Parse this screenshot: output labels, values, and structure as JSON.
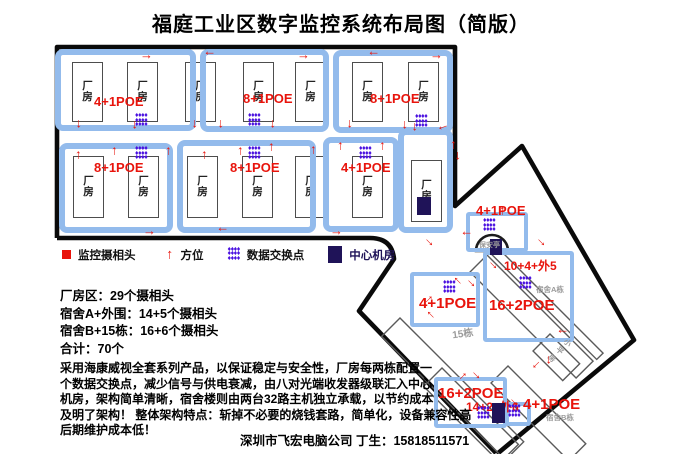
{
  "title": "福庭工业区数字监控系统布局图（简版）",
  "colors": {
    "red": "#e8140c",
    "purple": "#4a10e0",
    "navy": "#1f1358",
    "group_blue": "#93bbec"
  },
  "icons": {
    "arrow": "→",
    "dot": "♦",
    "camera": "camera-square",
    "direction": "direction-arrow",
    "switch": "switch-dots",
    "server": "server-square"
  },
  "factory": {
    "building_label": "厂\n房",
    "group_boxes": [
      {
        "x": 55,
        "y": 49,
        "w": 141,
        "h": 82
      },
      {
        "x": 200,
        "y": 49,
        "w": 129,
        "h": 83
      },
      {
        "x": 333,
        "y": 50,
        "w": 120,
        "h": 83
      },
      {
        "x": 59,
        "y": 143,
        "w": 114,
        "h": 90
      },
      {
        "x": 177,
        "y": 140,
        "w": 139,
        "h": 93
      },
      {
        "x": 323,
        "y": 137,
        "w": 76,
        "h": 95
      },
      {
        "x": 398,
        "y": 129,
        "w": 55,
        "h": 104
      }
    ],
    "buildings": [
      {
        "x": 72,
        "y": 62,
        "w": 31,
        "h": 60
      },
      {
        "x": 127,
        "y": 62,
        "w": 31,
        "h": 60
      },
      {
        "x": 185,
        "y": 62,
        "w": 31,
        "h": 60
      },
      {
        "x": 243,
        "y": 62,
        "w": 31,
        "h": 60
      },
      {
        "x": 295,
        "y": 62,
        "w": 31,
        "h": 60
      },
      {
        "x": 352,
        "y": 62,
        "w": 31,
        "h": 60
      },
      {
        "x": 408,
        "y": 62,
        "w": 31,
        "h": 60
      },
      {
        "x": 73,
        "y": 156,
        "w": 31,
        "h": 62
      },
      {
        "x": 128,
        "y": 156,
        "w": 31,
        "h": 62
      },
      {
        "x": 187,
        "y": 156,
        "w": 31,
        "h": 62
      },
      {
        "x": 242,
        "y": 156,
        "w": 31,
        "h": 62
      },
      {
        "x": 295,
        "y": 156,
        "w": 31,
        "h": 62
      },
      {
        "x": 352,
        "y": 156,
        "w": 31,
        "h": 62
      },
      {
        "x": 411,
        "y": 160,
        "w": 31,
        "h": 62
      }
    ],
    "poe_labels": [
      {
        "x": 94,
        "y": 94,
        "t": "4+1POE",
        "s": 13
      },
      {
        "x": 243,
        "y": 91,
        "t": "8+1POE",
        "s": 13
      },
      {
        "x": 370,
        "y": 91,
        "t": "8+1POE",
        "s": 13
      },
      {
        "x": 94,
        "y": 160,
        "t": "8+1POE",
        "s": 13
      },
      {
        "x": 230,
        "y": 160,
        "t": "8+1POE",
        "s": 13
      },
      {
        "x": 341,
        "y": 160,
        "t": "4+1POE",
        "s": 13
      }
    ],
    "switch_points": [
      {
        "x": 135,
        "y": 114
      },
      {
        "x": 248,
        "y": 114
      },
      {
        "x": 415,
        "y": 115
      },
      {
        "x": 135,
        "y": 147
      },
      {
        "x": 248,
        "y": 147
      },
      {
        "x": 359,
        "y": 147
      }
    ],
    "server_rooms": [
      {
        "x": 417,
        "y": 197,
        "w": 14,
        "h": 18
      }
    ],
    "arrows": [
      {
        "x": 140,
        "y": 50,
        "r": 0
      },
      {
        "x": 203,
        "y": 50,
        "r": 180
      },
      {
        "x": 297,
        "y": 50,
        "r": 0
      },
      {
        "x": 367,
        "y": 50,
        "r": 180
      },
      {
        "x": 430,
        "y": 50,
        "r": 0
      },
      {
        "x": 74,
        "y": 119,
        "r": 90
      },
      {
        "x": 130,
        "y": 120,
        "r": 90
      },
      {
        "x": 190,
        "y": 119,
        "r": 90
      },
      {
        "x": 216,
        "y": 119,
        "r": 90
      },
      {
        "x": 268,
        "y": 119,
        "r": 90
      },
      {
        "x": 345,
        "y": 119,
        "r": 90
      },
      {
        "x": 400,
        "y": 120,
        "r": 90
      },
      {
        "x": 410,
        "y": 122,
        "r": 90
      },
      {
        "x": 437,
        "y": 124,
        "r": 160
      },
      {
        "x": 70,
        "y": 150,
        "r": 270
      },
      {
        "x": 106,
        "y": 146,
        "r": 270
      },
      {
        "x": 160,
        "y": 146,
        "r": 270
      },
      {
        "x": 196,
        "y": 150,
        "r": 270
      },
      {
        "x": 232,
        "y": 146,
        "r": 270
      },
      {
        "x": 263,
        "y": 142,
        "r": 270
      },
      {
        "x": 305,
        "y": 145,
        "r": 270
      },
      {
        "x": 332,
        "y": 141,
        "r": 270
      },
      {
        "x": 374,
        "y": 141,
        "r": 270
      },
      {
        "x": 445,
        "y": 140,
        "r": 270
      },
      {
        "x": 453,
        "y": 151,
        "r": 90
      },
      {
        "x": 143,
        "y": 226,
        "r": 0
      },
      {
        "x": 216,
        "y": 226,
        "r": 180
      },
      {
        "x": 330,
        "y": 226,
        "r": 0
      },
      {
        "x": 424,
        "y": 236,
        "r": 45
      }
    ]
  },
  "dorm": {
    "booth_label": "保安亭",
    "blue_boxes": [
      {
        "x": 466,
        "y": 212,
        "w": 62,
        "h": 40
      },
      {
        "x": 410,
        "y": 272,
        "w": 70,
        "h": 55
      },
      {
        "x": 483,
        "y": 251,
        "w": 91,
        "h": 91
      },
      {
        "x": 434,
        "y": 377,
        "w": 73,
        "h": 51
      },
      {
        "x": 505,
        "y": 402,
        "w": 26,
        "h": 24
      }
    ],
    "poe_labels": [
      {
        "x": 476,
        "y": 203,
        "t": "4+1POE",
        "s": 13
      },
      {
        "x": 504,
        "y": 257,
        "t": "10+4+外5",
        "s": 12
      },
      {
        "x": 489,
        "y": 297,
        "t": "16+2POE",
        "s": 15
      },
      {
        "x": 419,
        "y": 295,
        "t": "4+1POE",
        "s": 15
      },
      {
        "x": 438,
        "y": 385,
        "t": "16+2POE",
        "s": 15
      },
      {
        "x": 466,
        "y": 398,
        "t": "14+2+外6",
        "s": 12
      },
      {
        "x": 523,
        "y": 396,
        "t": "4+1POE",
        "s": 15
      }
    ],
    "switch_points": [
      {
        "x": 483,
        "y": 219
      },
      {
        "x": 519,
        "y": 277
      },
      {
        "x": 443,
        "y": 281
      },
      {
        "x": 477,
        "y": 407
      },
      {
        "x": 508,
        "y": 405
      }
    ],
    "server_rooms": [
      {
        "x": 490,
        "y": 239,
        "w": 12,
        "h": 16
      },
      {
        "x": 492,
        "y": 403,
        "w": 13,
        "h": 20
      }
    ],
    "gray_labels": [
      {
        "x": 536,
        "y": 284,
        "t": "宿舍A栋",
        "s": 7.5,
        "rot": 0
      },
      {
        "x": 452,
        "y": 325,
        "t": "15栋",
        "s": 10,
        "rot": -8
      },
      {
        "x": 556,
        "y": 334,
        "t": "小\n平\n房",
        "s": 7.5,
        "rot": 45
      },
      {
        "x": 546,
        "y": 412,
        "t": "宿舍B栋",
        "s": 7.5,
        "rot": 0
      }
    ],
    "arrows": [
      {
        "x": 460,
        "y": 230,
        "r": 180
      },
      {
        "x": 494,
        "y": 206,
        "r": 270
      },
      {
        "x": 536,
        "y": 236,
        "r": 45
      },
      {
        "x": 488,
        "y": 259,
        "r": 45
      },
      {
        "x": 450,
        "y": 277,
        "r": 225
      },
      {
        "x": 466,
        "y": 277,
        "r": 45
      },
      {
        "x": 421,
        "y": 293,
        "r": 315
      },
      {
        "x": 423,
        "y": 311,
        "r": 225
      },
      {
        "x": 556,
        "y": 328,
        "r": 180
      },
      {
        "x": 531,
        "y": 361,
        "r": 135
      },
      {
        "x": 544,
        "y": 355,
        "r": 90
      },
      {
        "x": 455,
        "y": 370,
        "r": 315
      },
      {
        "x": 471,
        "y": 369,
        "r": 45
      },
      {
        "x": 509,
        "y": 396,
        "r": 45
      }
    ]
  },
  "legend": {
    "items": [
      {
        "icon": "camera-square",
        "label": "监控摄相头"
      },
      {
        "icon": "direction-arrow",
        "label": "方位"
      },
      {
        "icon": "switch-dots",
        "label": "数据交换点"
      },
      {
        "icon": "server-square",
        "label": "中心机房"
      }
    ]
  },
  "stats": {
    "lines": [
      "厂房区：29个摄相头",
      "宿舍A+外围：14+5个摄相头",
      "宿舍B+15栋：16+6个摄相头",
      "合计：70个"
    ]
  },
  "description": {
    "lines": [
      "采用海康威视全套系列产品，以保证稳定与安全性，厂房每两栋配置一",
      "个数据交换点，减少信号与供电衰减，由八对光端收发器级联汇入中心",
      "机房，架构简单清晰，宿舍楼则由两台32路主机独立承载，以节约成本",
      "及明了架构！ 整体架构特点：斩掉不必要的烧钱套路，简单化，设备兼容性高",
      "后期维护成本低！"
    ]
  },
  "footer": "深圳市飞宏电脑公司 丁生：15818511571"
}
